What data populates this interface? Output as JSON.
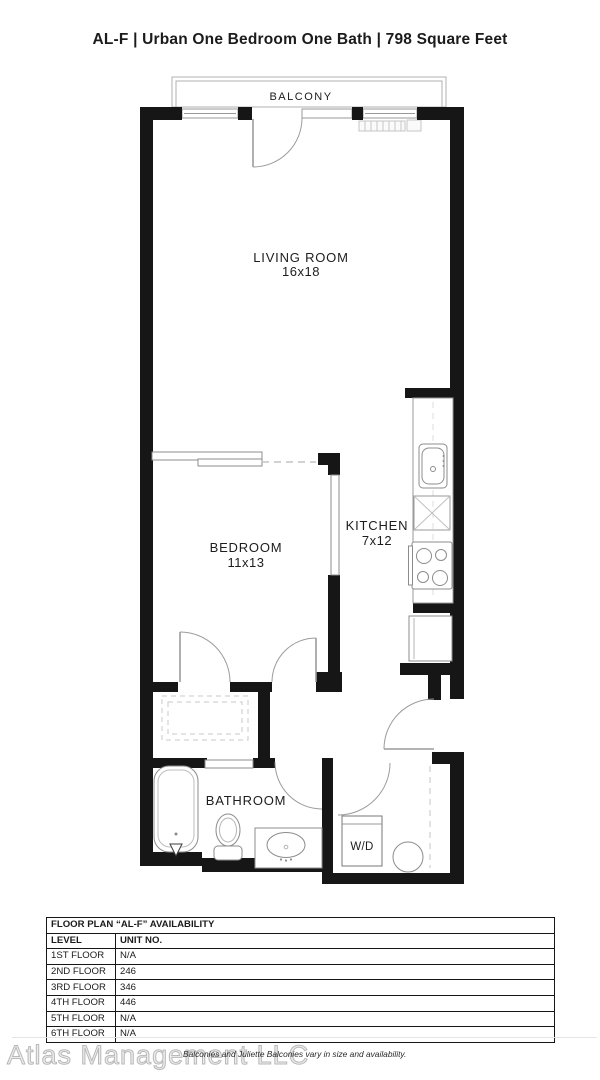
{
  "header": {
    "title": "AL-F | Urban One Bedroom One Bath | 798 Square Feet"
  },
  "floor_plan": {
    "balcony_label": "BALCONY",
    "living_room": {
      "name": "LIVING ROOM",
      "dims": "16x18"
    },
    "bedroom": {
      "name": "BEDROOM",
      "dims": "11x13"
    },
    "kitchen": {
      "name": "KITCHEN",
      "dims": "7x12"
    },
    "bathroom": {
      "name": "BATHROOM"
    },
    "laundry": {
      "name": "W/D"
    }
  },
  "availability_table": {
    "title": "FLOOR PLAN “AL-F” AVAILABILITY",
    "columns": {
      "level": "LEVEL",
      "unit": "UNIT NO."
    },
    "rows": [
      {
        "level": "1ST FLOOR",
        "unit": "N/A"
      },
      {
        "level": "2ND FLOOR",
        "unit": "246"
      },
      {
        "level": "3RD FLOOR",
        "unit": "346"
      },
      {
        "level": "4TH FLOOR",
        "unit": "446"
      },
      {
        "level": "5TH FLOOR",
        "unit": "N/A"
      },
      {
        "level": "6TH FLOOR",
        "unit": "N/A"
      }
    ]
  },
  "footer": {
    "watermark": "Atlas Management LLC",
    "disclaimer": "Balconies and Juliette Balconies vary in size and availability."
  },
  "colors": {
    "wall": "#161616",
    "fixture_line": "#8c8c8c",
    "light_line": "#c0c0c0",
    "text": "#1d1d1d"
  }
}
